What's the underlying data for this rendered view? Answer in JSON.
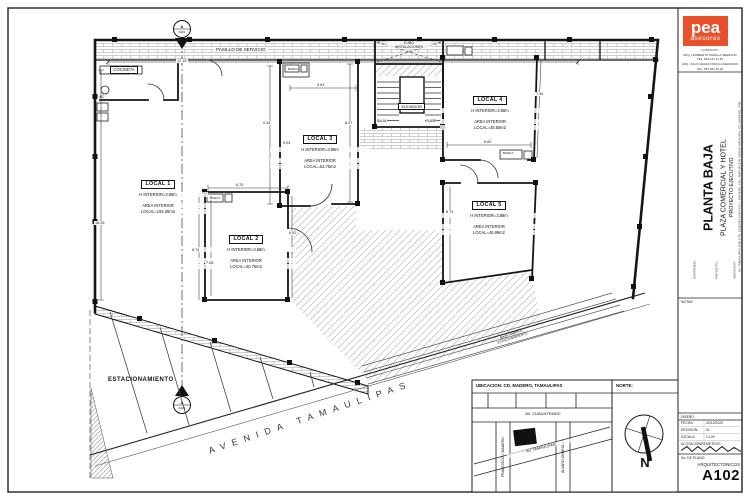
{
  "logo": {
    "name": "pea",
    "tagline": "asesores",
    "accent": "#e8512b",
    "contact": [
      "CONTACTO:",
      "ARQ. HUMBERTO PADILLA SERRANO",
      "TEL. 833 217 11 81",
      "ARQ. JULIO CESAR PADILLA SERRANO",
      "TEL. 833 831 48 84"
    ]
  },
  "titleblock": {
    "contenido_label": "CONTENIDO:",
    "proyecto_label": "PROYECTO:",
    "ubicacion_label": "UBICACION:",
    "sheet_title": "PLANTA BAJA",
    "project": "PLAZA COMERCIAL Y HOTEL",
    "phase": "PROYECTO EJECUTIVO",
    "address": "AV. TAMAULIPAS 3500 OTE. ESQUINA CON FCO. I. MADERO, COL. AMPLIACION UNIDAD NACIONAL, CD. MADERO, TAM.",
    "notas_label": "NOTAS:",
    "diseno_label": "DISEÑO:",
    "fecha_label": "FECHA:",
    "fecha": "22/12/2022",
    "revision_label": "REVISION:",
    "revision": "01",
    "escala_label": "ESCALA:",
    "escala": "1:125",
    "acot_label": "ACOTACIONES:",
    "acot": "METROS",
    "plano_label": "No. DE PLANO:",
    "discipline": "ARQUITECTONICOS",
    "number": "A102"
  },
  "location": {
    "title": "UBICACION: CD. MADERO, TAMAULIPAS",
    "norte": "NORTE:",
    "cuauhtemoc": "AV. CUAUHTEMOC",
    "francisco": "FRANCISCO I. MADERO",
    "obregon": "ALVARO OBREGON",
    "tamaulipas": "AV. TAMAULIPAS",
    "north_letter": "N"
  },
  "plan": {
    "corridor": "PASILLO DE SERVICIO",
    "cocineta": "COCINETA",
    "wc": "WC",
    "banca": "BANCA",
    "cubo_line1": "CUBO",
    "cubo_line2": "INSTALACIONES",
    "elevador": "ELEVADOR",
    "baja": "BAJA",
    "sube": "SUBE",
    "estacionamiento": "ESTACIONAMIENTO",
    "avenida": "AVENIDA TAMAULIPAS",
    "rampa_line1": "BAJA RAMPA A",
    "rampa_line2": "ESTACIONAMIENTO",
    "marker_letter": "A",
    "marker_sheet": "A301",
    "locals": [
      {
        "name": "LOCAL 1",
        "h": "H INTERIOR=3.88m",
        "a1": "AREA INTERIOR",
        "a2": "LOCAL=194.39m2"
      },
      {
        "name": "LOCAL 2",
        "h": "H INTERIOR=3.88m",
        "a1": "AREA INTERIOR",
        "a2": "LOCAL=40.76m2"
      },
      {
        "name": "LOCAL 3",
        "h": "H INTERIOR=3.88m",
        "a1": "AREA INTERIOR",
        "a2": "LOCAL=52.76m2"
      },
      {
        "name": "LOCAL 4",
        "h": "H INTERIOR=3.88m",
        "a1": "AREA INTERIOR",
        "a2": "LOCAL=48.55m2"
      },
      {
        "name": "LOCAL 5",
        "h": "H INTERIOR=3.88m",
        "a1": "AREA INTERIOR",
        "a2": "LOCAL=46.99m2"
      }
    ],
    "dims": {
      "total_width": "12.18",
      "left_height": "18.26",
      "local3_top": "5.63",
      "local3_h_left": "9.34",
      "local3_left": "9.04",
      "local3_h_right": "8.47",
      "local2_top": "6.70",
      "local2_left": "8.74",
      "local2_inner": "7.08",
      "local2_right": "6.52",
      "local5_left": "8.74",
      "local4_right": "7.46",
      "local4_bottom": "6.60"
    }
  }
}
